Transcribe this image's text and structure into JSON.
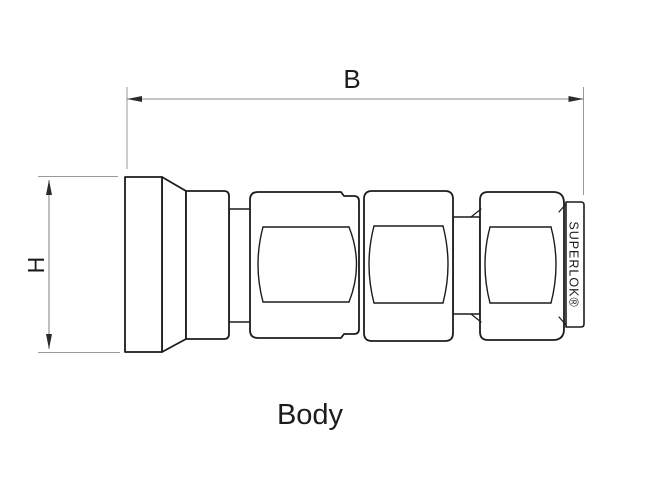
{
  "drawing": {
    "part_label": "Body",
    "horizontal_dimension_label": "B",
    "vertical_dimension_label": "H",
    "brand_engraving": "SUPERLOK®",
    "colors": {
      "outline": "#1c1c1c",
      "dimension_lines": "#8a8a8a",
      "text": "#1c1c1c",
      "background": "#ffffff"
    }
  }
}
